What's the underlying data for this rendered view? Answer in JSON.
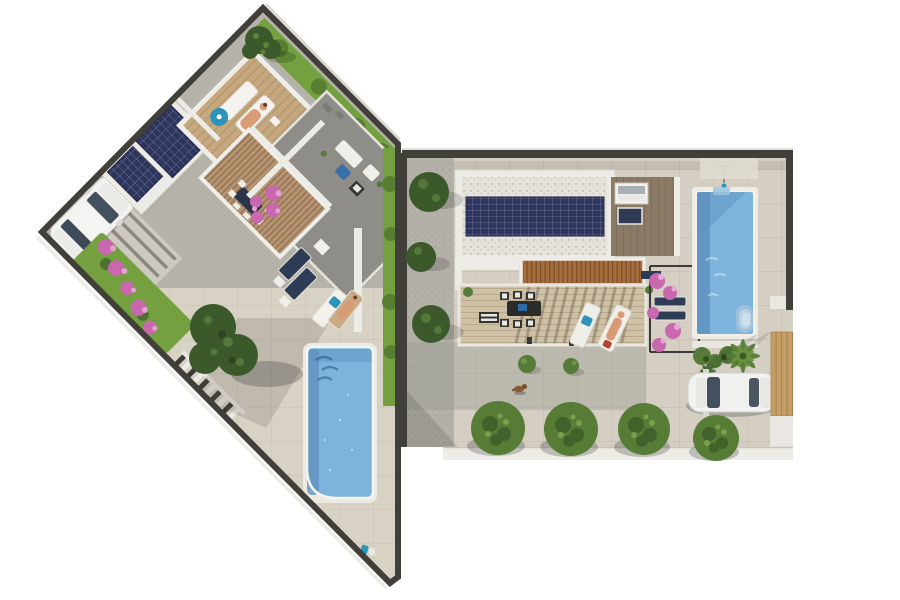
{
  "meta": {
    "title": "Top-down aerial 3D render of two modern villa plots with swimming pools",
    "image_type": "architectural-render",
    "view": "top-down aerial",
    "visible_text": "none"
  },
  "palette": {
    "background": "#ffffff",
    "wall_dark": "#413f39",
    "paving_gray": "#b5b2aa",
    "paving_beige": "#d8d2c5",
    "tile_beige": "#d5cfc3",
    "gravel_gray": "#b3b1a8",
    "roof_gray": "#8e8d88",
    "roof_white": "#ecebe5",
    "roof_gravel_white": "#e6e3da",
    "deck_wood": "#c6a87f",
    "terrace_wood": "#cfc1a5",
    "roof_wood_dark": "#8b7b66",
    "pergola_wood": "#b59472",
    "pergola_terracotta": "#a56d3e",
    "solar_navy": "#2e355c",
    "pool_blue": "#7db4db",
    "pool_deep": "#5e92c1",
    "grass_green": "#74a040",
    "tree_green": "#567c36",
    "tree_dark": "#3c592b",
    "shrub_green": "#567b39",
    "bougainvillea_pink": "#c968ae",
    "car_white": "#f2f2f0",
    "glass_dark": "#44505d",
    "fence_tan": "#c49d67",
    "navy_cushion": "#2e3c55",
    "teal_accent": "#2d93b8",
    "skin_tone": "#d89b76"
  },
  "left_villa": {
    "label": "left-villa-plot",
    "rotation_deg": 45,
    "elements": [
      "dark boundary wall",
      "perimeter grass strip with hedges",
      "driveway shaded by pergola beams",
      "white car",
      "two rooftop solar panels",
      "wooden roof deck with two sun loungers and a person",
      "teal parasol",
      "gray roof terrace with lounge furniture and blue table",
      "pergola-covered dining terrace",
      "bougainvillea in bloom",
      "garden staircase",
      "swimming pool with ripple shadows",
      "beige pool terrace",
      "poolside lounger with teal towel",
      "standing person",
      "trees overhanging the wall"
    ],
    "counts": {
      "cars": 1,
      "pools": 1,
      "solar_panels": 2,
      "sun_loungers": 6,
      "people": 2,
      "trees": 2
    }
  },
  "right_villa": {
    "label": "right-villa-plot",
    "elements": [
      "dark boundary wall",
      "gravel side garden with trees",
      "flat roof with white gravel and large solar array",
      "wood roof deck with two skylights",
      "terracotta pergola",
      "dining terrace with table and six chairs",
      "two sun loungers with a person",
      "bougainvillea trellis with navy loungers",
      "swimming pool with steps",
      "outdoor shower",
      "poolside planting",
      "palm tree",
      "white car on driveway",
      "tan privacy fence",
      "row of street trees",
      "sidewalk",
      "small dog"
    ],
    "counts": {
      "cars": 1,
      "pools": 1,
      "solar_arrays": 1,
      "skylights": 2,
      "dining_chairs": 6,
      "sun_loungers": 4,
      "people": 1,
      "street_trees": 4,
      "dogs": 1
    }
  }
}
